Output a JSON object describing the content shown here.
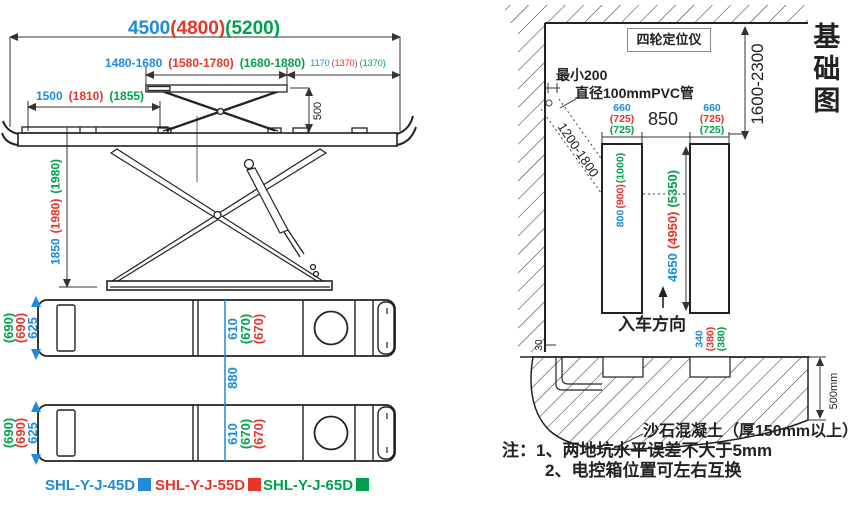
{
  "colors": {
    "blue": "#1e8bdc",
    "red": "#e8342b",
    "green": "#00a14e",
    "ink": "#222222"
  },
  "side_view": {
    "overall_length": {
      "v45": "4500",
      "v55": "(4800)",
      "v65": "(5200)"
    },
    "lift_range": {
      "v45": "1480-1680",
      "v55": "(1580-1780)",
      "v65": "(1680-1880)"
    },
    "rear_length": {
      "v45": "1170",
      "v55": "(1370)",
      "v65": "(1370)"
    },
    "front_platform": {
      "v45": "1500",
      "v55": "(1810)",
      "v65": "(1855)"
    },
    "secondary_lift_height": "500",
    "max_height": {
      "v45": "1850",
      "v55": "(1980)",
      "v65": "(1980)"
    }
  },
  "top_view": {
    "platform_width": {
      "v45": "625",
      "v55": "(690)",
      "v65": "(690)"
    },
    "track_width": {
      "v45": "610",
      "v55": "(670)",
      "v65": "(670)"
    },
    "track_gap": "880"
  },
  "legend": {
    "models": [
      {
        "name": "SHL-Y-J-45D"
      },
      {
        "name": "SHL-Y-J-55D"
      },
      {
        "name": "SHL-Y-J-65D"
      }
    ]
  },
  "foundation": {
    "title": "基础图",
    "aligner_label": "四轮定位仪",
    "bay_width_range": "1600-2300",
    "min_clearance": "最小200",
    "pvc_pipe_label": "直径100mmPVC管",
    "pipe_length_range": "1200-1800",
    "pit_width_left": {
      "v45": "660",
      "v55": "(725)",
      "v65": "(725)"
    },
    "pit_width_right": {
      "v45": "660",
      "v55": "(725)",
      "v65": "(725)"
    },
    "pit_gap": "850",
    "pit_head_length": {
      "v45": "800",
      "v55": "(900)",
      "v65": "(1000)"
    },
    "pit_length": {
      "v45": "4650",
      "v55": "(4950)",
      "v65": "(5350)"
    },
    "drive_in_label": "入车方向",
    "pit_end_offset": {
      "v45": "340",
      "v55": "(380)",
      "v65": "(380)"
    },
    "wall_gap": "30",
    "slab_depth": "500mm",
    "concrete_label": "沙石混凝土（厚150mm以上）",
    "notes_title": "注：",
    "note_1": "1、两地坑水平误差不大于5mm",
    "note_2": "2、电控箱位置可左右互换"
  }
}
